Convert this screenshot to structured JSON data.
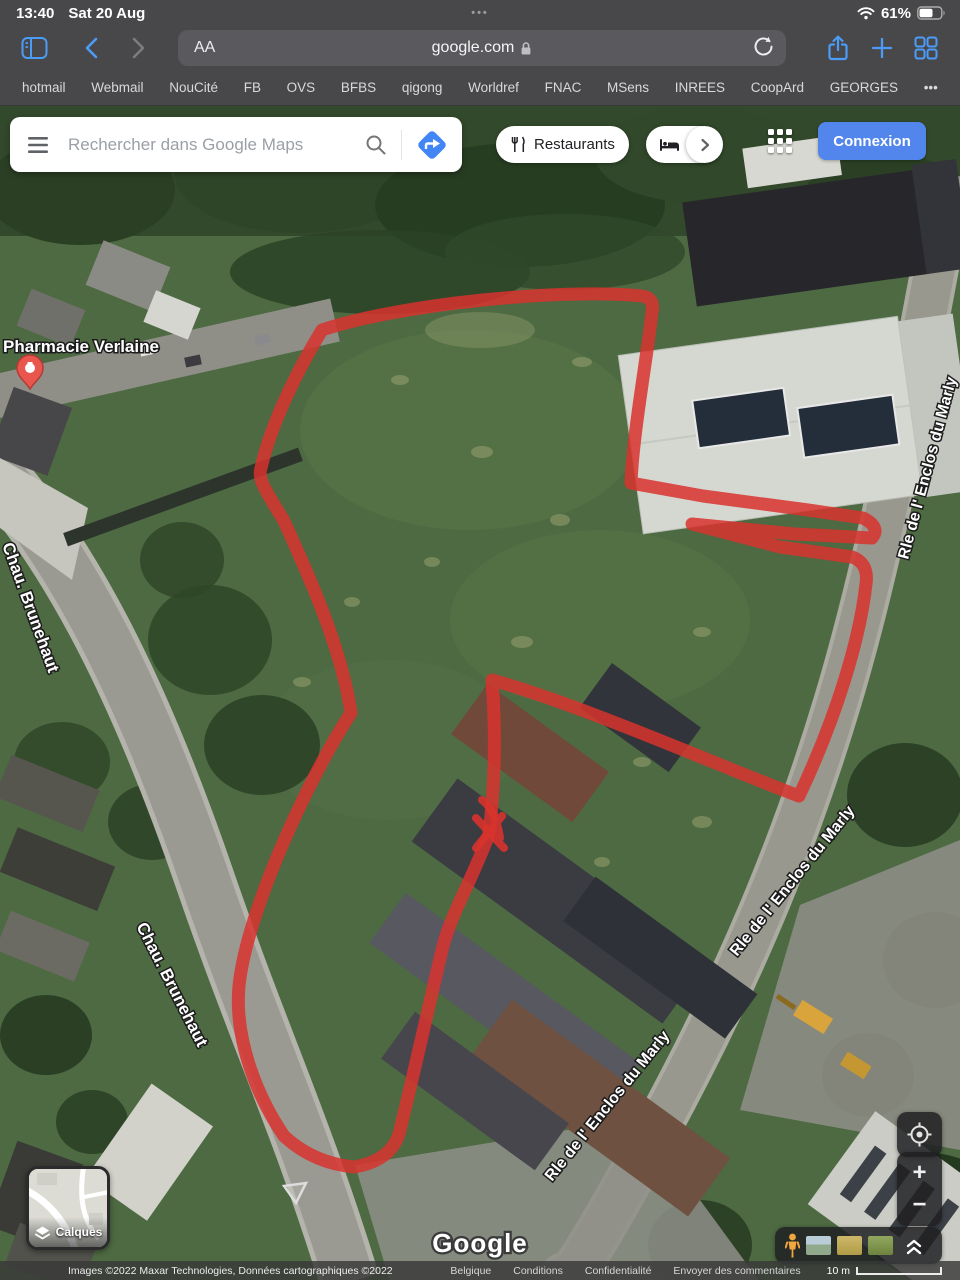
{
  "status_bar": {
    "time": "13:40",
    "date": "Sat 20 Aug",
    "center_dots": "•••",
    "battery": "61%"
  },
  "toolbar": {
    "reader": "AA",
    "url": "google.com"
  },
  "bookmarks": {
    "items": [
      "hotmail",
      "Webmail",
      "NouCité",
      "FB",
      "OVS",
      "BFBS",
      "qigong",
      "Worldref",
      "FNAC",
      "MSens",
      "INREES",
      "CoopArd",
      "GEORGES"
    ],
    "more": "•••"
  },
  "maps": {
    "search_placeholder": "Rechercher dans Google Maps",
    "chip_restaurants": "Restaurants",
    "chip_hotels": "H",
    "signin": "Connexion",
    "layers": "Calques",
    "logo": "Google",
    "zoom_in": "+",
    "zoom_out": "−",
    "colors": {
      "signin_blue": "#5286ec",
      "boundary_red": "#d8332e",
      "directions_blue": "#4285f4"
    }
  },
  "map_labels": {
    "pharmacy": "Pharmacie Verlaine",
    "street_brunehaut": "Chau. Brunehaut",
    "street_marly": "Rle de l' Enclos du Marly"
  },
  "attribution": {
    "imagery": "Images ©2022 Maxar Technologies, Données cartographiques ©2022",
    "links": [
      "Belgique",
      "Conditions",
      "Confidentialité",
      "Envoyer des commentaires"
    ],
    "scale": "10 m"
  }
}
